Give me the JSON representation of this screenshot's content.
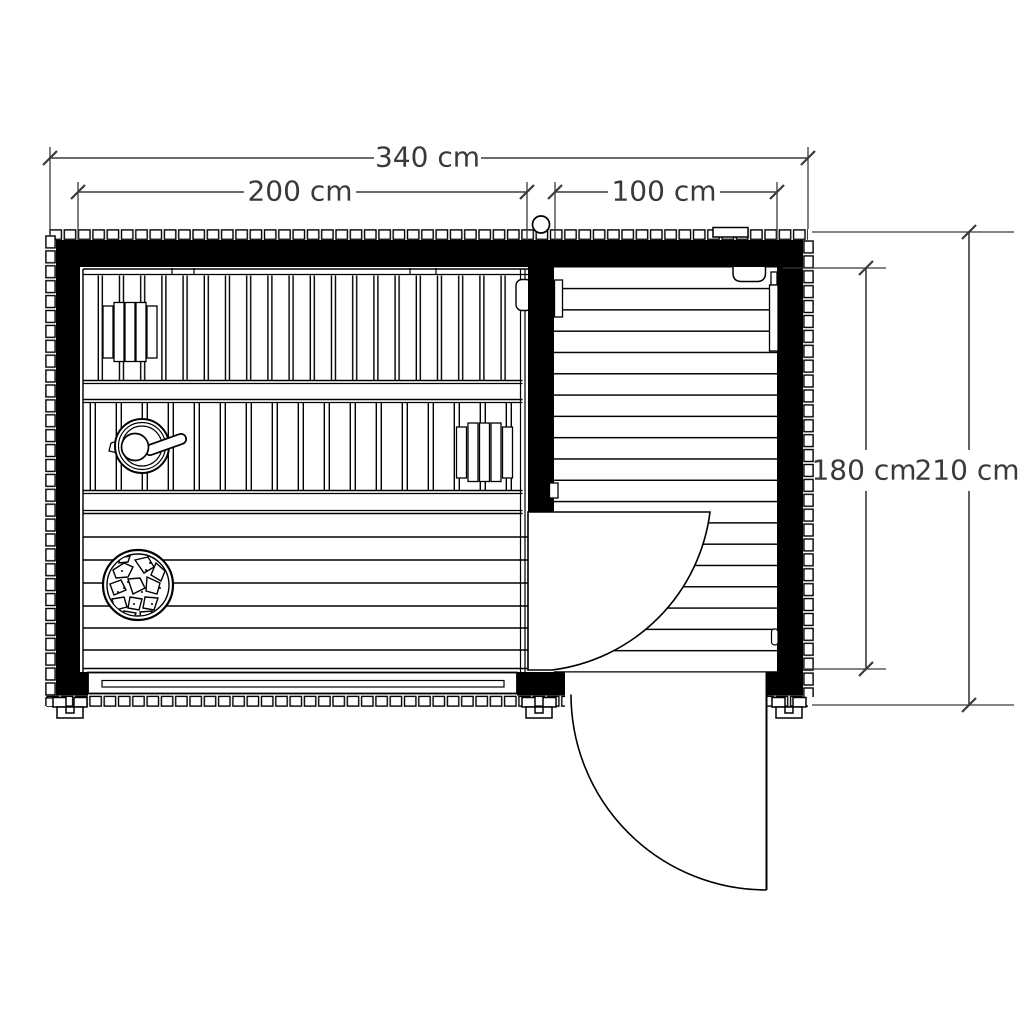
{
  "dimension_labels": {
    "total_width": "340 cm",
    "sauna_width": "200 cm",
    "terrace_width": "100 cm",
    "interior_depth": "180 cm",
    "total_depth": "210 cm"
  },
  "colors": {
    "drawing_line": "#000000",
    "wall_fill": "#000000",
    "dimension_line": "#3a3a3a",
    "background": "#ffffff"
  }
}
